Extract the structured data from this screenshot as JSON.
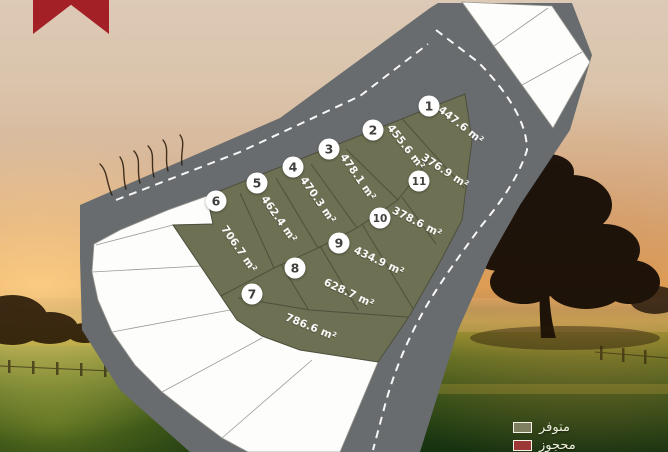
{
  "ribbon": {
    "color": "#a32026"
  },
  "map": {
    "road_color": "#686c6e",
    "available_color": "#6e7053",
    "vacant_color": "#fdfdfc",
    "plots": [
      {
        "number": "1",
        "area": "447.6 m²"
      },
      {
        "number": "2",
        "area": "455.6 m²"
      },
      {
        "number": "3",
        "area": "478.1 m²"
      },
      {
        "number": "4",
        "area": "470.3 m²"
      },
      {
        "number": "5",
        "area": "462.4 m²"
      },
      {
        "number": "6",
        "area": "706.7 m²"
      },
      {
        "number": "7",
        "area": "786.6 m²"
      },
      {
        "number": "8",
        "area": "628.7 m²"
      },
      {
        "number": "9",
        "area": "434.9 m²"
      },
      {
        "number": "10",
        "area": "378.6 m²"
      },
      {
        "number": "11",
        "area": "376.9 m²"
      }
    ]
  },
  "legend": {
    "items": [
      {
        "label": "متوفر",
        "status": "available",
        "color": "#7f7f62"
      },
      {
        "label": "محجوز",
        "status": "reserved",
        "color": "#9c3836"
      }
    ]
  }
}
